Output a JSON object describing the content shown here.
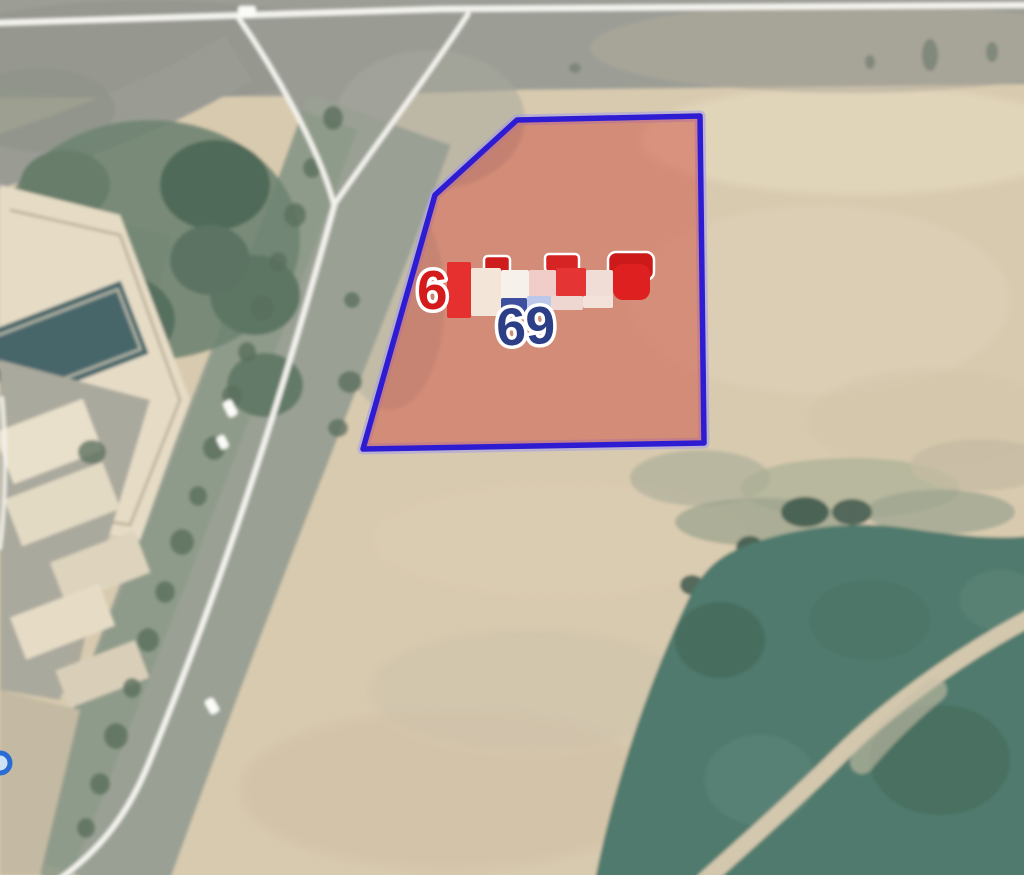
{
  "map": {
    "view_type": "satellite-parcel-view",
    "parcel": {
      "number_prefix_digit": "6",
      "number_redacted": true,
      "block_label": "69",
      "polygon_points": "517,120 700,116 704,443 363,449 435,195",
      "fill_color": "rgba(204,62,48,0.44)",
      "border_color": "#2e1cd2",
      "halo_color": "#a29bea"
    },
    "labels": {
      "parcel_number_visible_digit": "6",
      "parcel_number_color": "#d41a1a",
      "block_number": "69",
      "block_number_color": "#2c3e85",
      "outline_color": "#ffffff"
    },
    "redaction_mosaic": [
      {
        "x": 484,
        "y": 256,
        "w": 26,
        "h": 18,
        "c": "#cf1d1d",
        "r": 4,
        "o": true
      },
      {
        "x": 545,
        "y": 254,
        "w": 34,
        "h": 18,
        "c": "#d62424",
        "r": 4,
        "o": true
      },
      {
        "x": 608,
        "y": 252,
        "w": 46,
        "h": 28,
        "c": "#cc1a1a",
        "r": 8,
        "o": true
      },
      {
        "x": 447,
        "y": 262,
        "w": 24,
        "h": 56,
        "c": "#e62f2f"
      },
      {
        "x": 471,
        "y": 268,
        "w": 30,
        "h": 48,
        "c": "#f3e6d9"
      },
      {
        "x": 501,
        "y": 270,
        "w": 28,
        "h": 30,
        "c": "#f7f1ec"
      },
      {
        "x": 529,
        "y": 270,
        "w": 27,
        "h": 28,
        "c": "#f0cdc9"
      },
      {
        "x": 556,
        "y": 268,
        "w": 30,
        "h": 28,
        "c": "#e43434"
      },
      {
        "x": 586,
        "y": 270,
        "w": 27,
        "h": 28,
        "c": "#f0ded6"
      },
      {
        "x": 613,
        "y": 264,
        "w": 37,
        "h": 36,
        "c": "#de2020",
        "r": 10
      },
      {
        "x": 501,
        "y": 298,
        "w": 26,
        "h": 16,
        "c": "#3d4f9e"
      },
      {
        "x": 527,
        "y": 296,
        "w": 24,
        "h": 18,
        "c": "#bcc7ea"
      },
      {
        "x": 551,
        "y": 296,
        "w": 32,
        "h": 14,
        "c": "#eed7d0"
      },
      {
        "x": 583,
        "y": 296,
        "w": 30,
        "h": 12,
        "c": "#f2e2da"
      }
    ],
    "edge_marker": {
      "shape": "circle",
      "ring_color": "#2a6bd4",
      "fill_color": "#cfe2f5"
    },
    "terrain_colors": {
      "sand": "#d8caaf",
      "road": "#9c9e96",
      "median_green": "#8e9a88",
      "tree_dark": "#4f6a58",
      "park_green": "#507a6d",
      "park_path": "#d3c8ae",
      "building": "#e6dcc6",
      "pool": "#47666a",
      "road_line_white": "#f4f3ee"
    }
  }
}
